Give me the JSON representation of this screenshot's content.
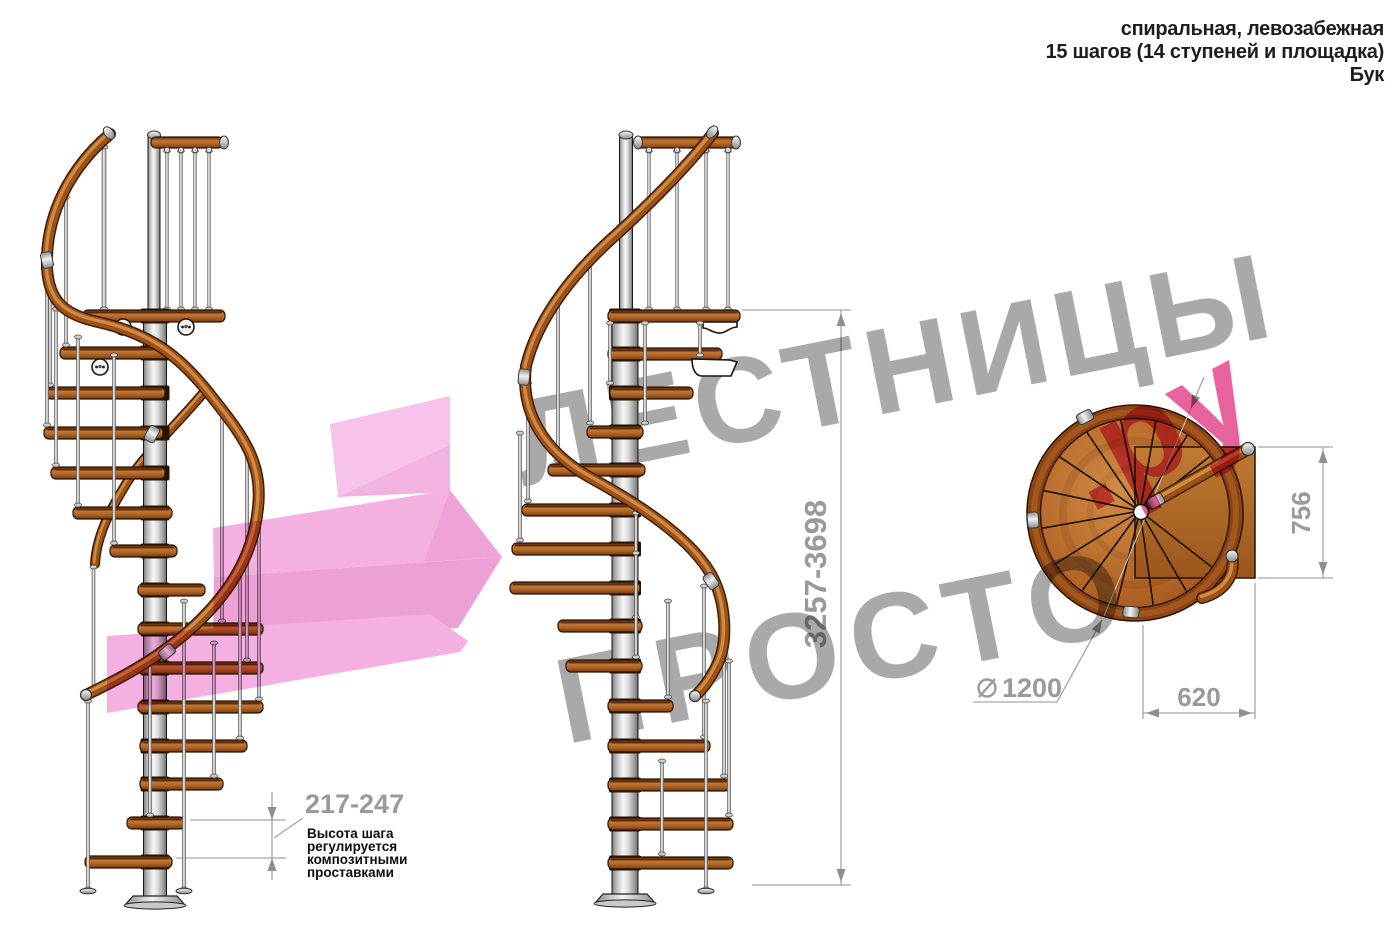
{
  "title_block": {
    "lines": [
      "спиральная, левозабежная",
      "15 шагов (14 ступеней и площадка)",
      "Бук"
    ]
  },
  "dimensions": {
    "total_height": "3257-3698",
    "step_height": "217-247",
    "landing_depth": "756",
    "landing_width": "620",
    "diameter": "1200"
  },
  "annotation": {
    "lines": [
      "Высота шага",
      "регулируется",
      "композитными",
      "проставками"
    ]
  },
  "watermark": {
    "line1": "ЛЕСТНИЦЫ",
    "line2": "ПРОСТО",
    "suffix": ".ру"
  },
  "colors": {
    "wood": "#b4682a",
    "chrome": "#d9d9d9",
    "dimension_gray": "#9a9a9a",
    "watermark_gray": "#a9a9a9",
    "watermark_pink": "#e8639e",
    "arrow_pink": "#f3b0e1",
    "text": "#1d1d1d"
  }
}
